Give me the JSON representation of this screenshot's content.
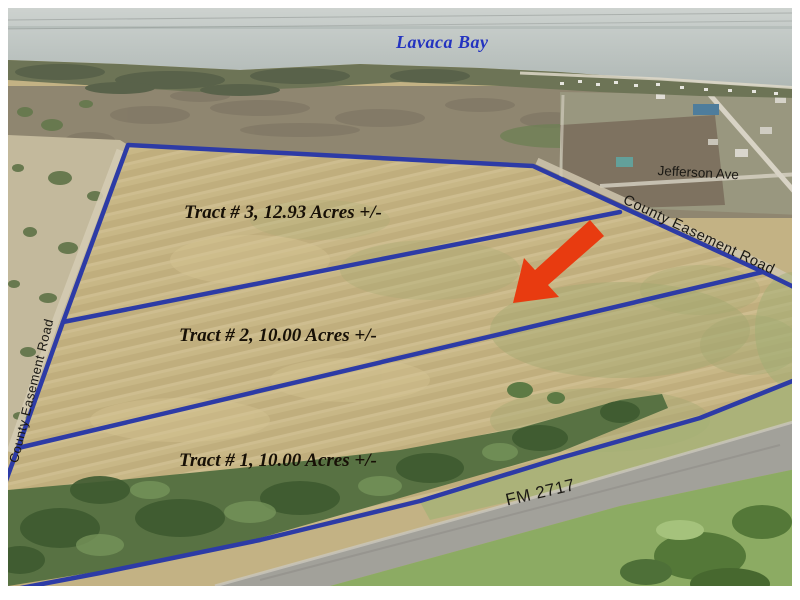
{
  "image": {
    "description": "Aerial land-for-sale plat photo with tract boundaries",
    "width_px": 800,
    "height_px": 600
  },
  "map": {
    "bay_label": "Lavaca Bay",
    "street_label": "Jefferson Ave",
    "easement_road_right_label": "County Easement Road",
    "easement_road_left_label": "County Easement Road",
    "highway_label": "FM 2717",
    "tracts": [
      {
        "id": "tract-3",
        "number": "3",
        "acres": "12.93",
        "label": "Tract # 3, 12.93 Acres +/-"
      },
      {
        "id": "tract-2",
        "number": "2",
        "acres": "10.00",
        "label": "Tract # 2, 10.00 Acres +/-"
      },
      {
        "id": "tract-1",
        "number": "1",
        "acres": "10.00",
        "label": "Tract # 1, 10.00 Acres +/-"
      }
    ]
  },
  "colors": {
    "boundary_blue": "#2d3ba6",
    "arrow_red": "#e83b10",
    "bay_label_blue": "#2433c0",
    "field_tan": "#c8b786",
    "tree_green": "#587243",
    "road_gray": "#a2a19a"
  }
}
